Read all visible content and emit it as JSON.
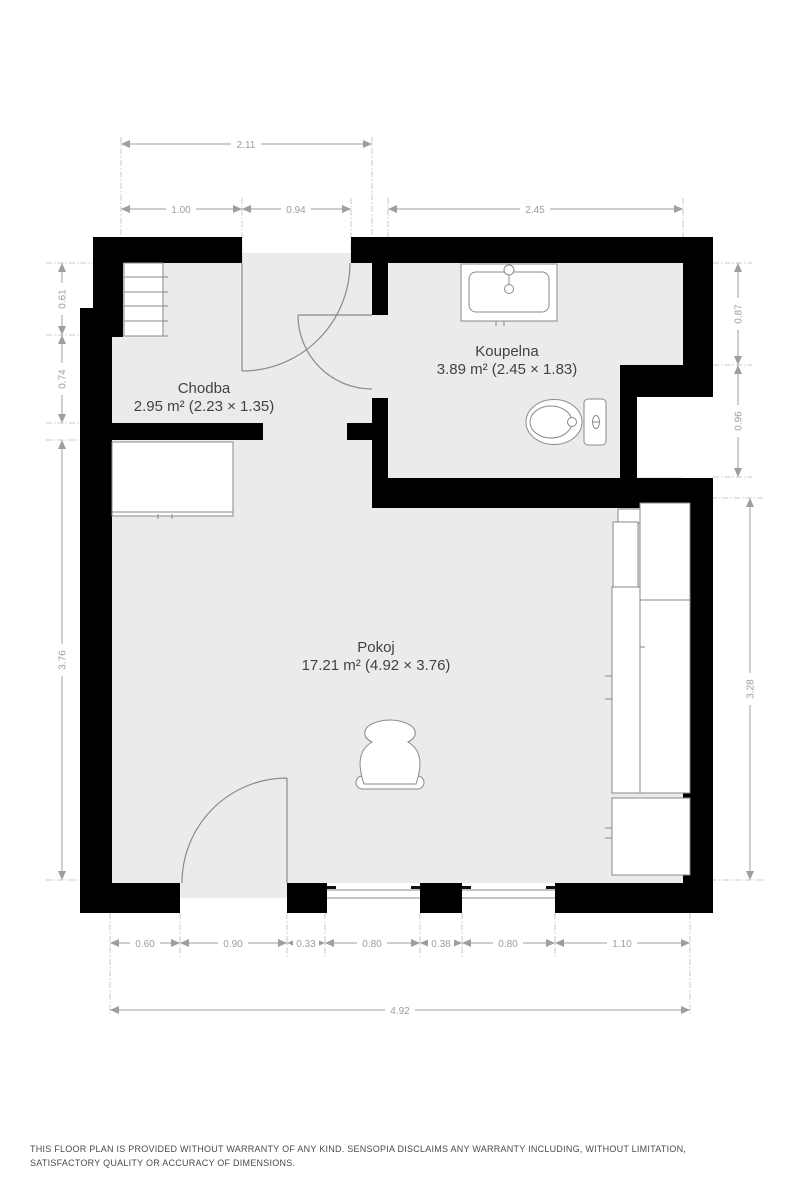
{
  "plan": {
    "rooms": [
      {
        "name": "Chodba",
        "area": "2.95 m² (2.23 × 1.35)"
      },
      {
        "name": "Koupelna",
        "area": "3.89 m² (2.45 × 1.83)"
      },
      {
        "name": "Pokoj",
        "area": "17.21 m² (4.92 × 3.76)"
      }
    ],
    "dimensions": {
      "top": "2.11",
      "upper": [
        "1.00",
        "0.94",
        "2.45"
      ],
      "left": [
        "0.61",
        "0.74",
        "3.76"
      ],
      "right": [
        "0.87",
        "0.96",
        "3.28"
      ],
      "bottom": [
        "0.60",
        "0.90",
        "0.33",
        "0.80",
        "0.38",
        "0.80",
        "1.10"
      ],
      "overall_width": "4.92"
    },
    "fixtures": [
      "stairs",
      "wardrobe",
      "sink",
      "toilet",
      "shelving-unit",
      "cabinet",
      "chair",
      "doors",
      "windows"
    ],
    "colors": {
      "walls": "#000000",
      "floor": "#ebebeb",
      "dimensions": "#9e9e9e",
      "room_labels": "#424242",
      "fixtures": "#8a8a8a"
    }
  },
  "footer": {
    "disclaimer": "THIS FLOOR PLAN IS PROVIDED WITHOUT WARRANTY OF ANY KIND. SENSOPIA DISCLAIMS ANY WARRANTY INCLUDING, WITHOUT LIMITATION, SATISFACTORY QUALITY OR ACCURACY OF DIMENSIONS."
  }
}
